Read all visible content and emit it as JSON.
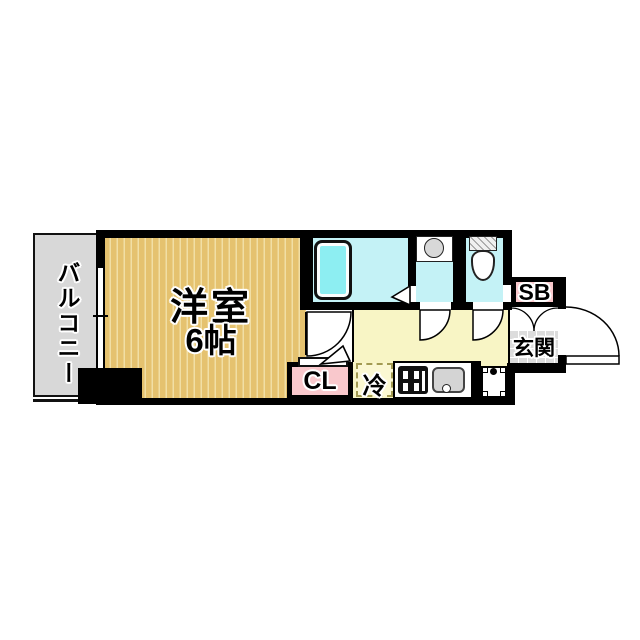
{
  "floor_plan": {
    "labels": {
      "balcony": "バルコニー",
      "main_room_name": "洋室",
      "main_room_size": "6帖",
      "closet": "CL",
      "refrigerator": "冷",
      "shoe_box": "SB",
      "entrance": "玄関"
    },
    "colors": {
      "wall": "#000000",
      "main_room_floor": "#e5c26f",
      "main_room_stripe": "#f1dfa5",
      "kitchen_floor": "#f8f5c5",
      "wet_area_floor": "#c4f2f6",
      "bathtub": "#8deef2",
      "balcony": "#d8d8d8",
      "entrance_tile": "#dcdcdc",
      "closet_fill": "#f9c8cc",
      "shoe_box_fill": "#f9c8cc"
    },
    "fixtures": [
      "bathtub",
      "washbasin",
      "toilet",
      "gas-stove",
      "kitchen-sink",
      "washing-machine-pan",
      "refrigerator-space",
      "entrance-door",
      "shoe-box-doors",
      "room-door",
      "washroom-door",
      "toilet-door",
      "window",
      "pillar"
    ]
  }
}
